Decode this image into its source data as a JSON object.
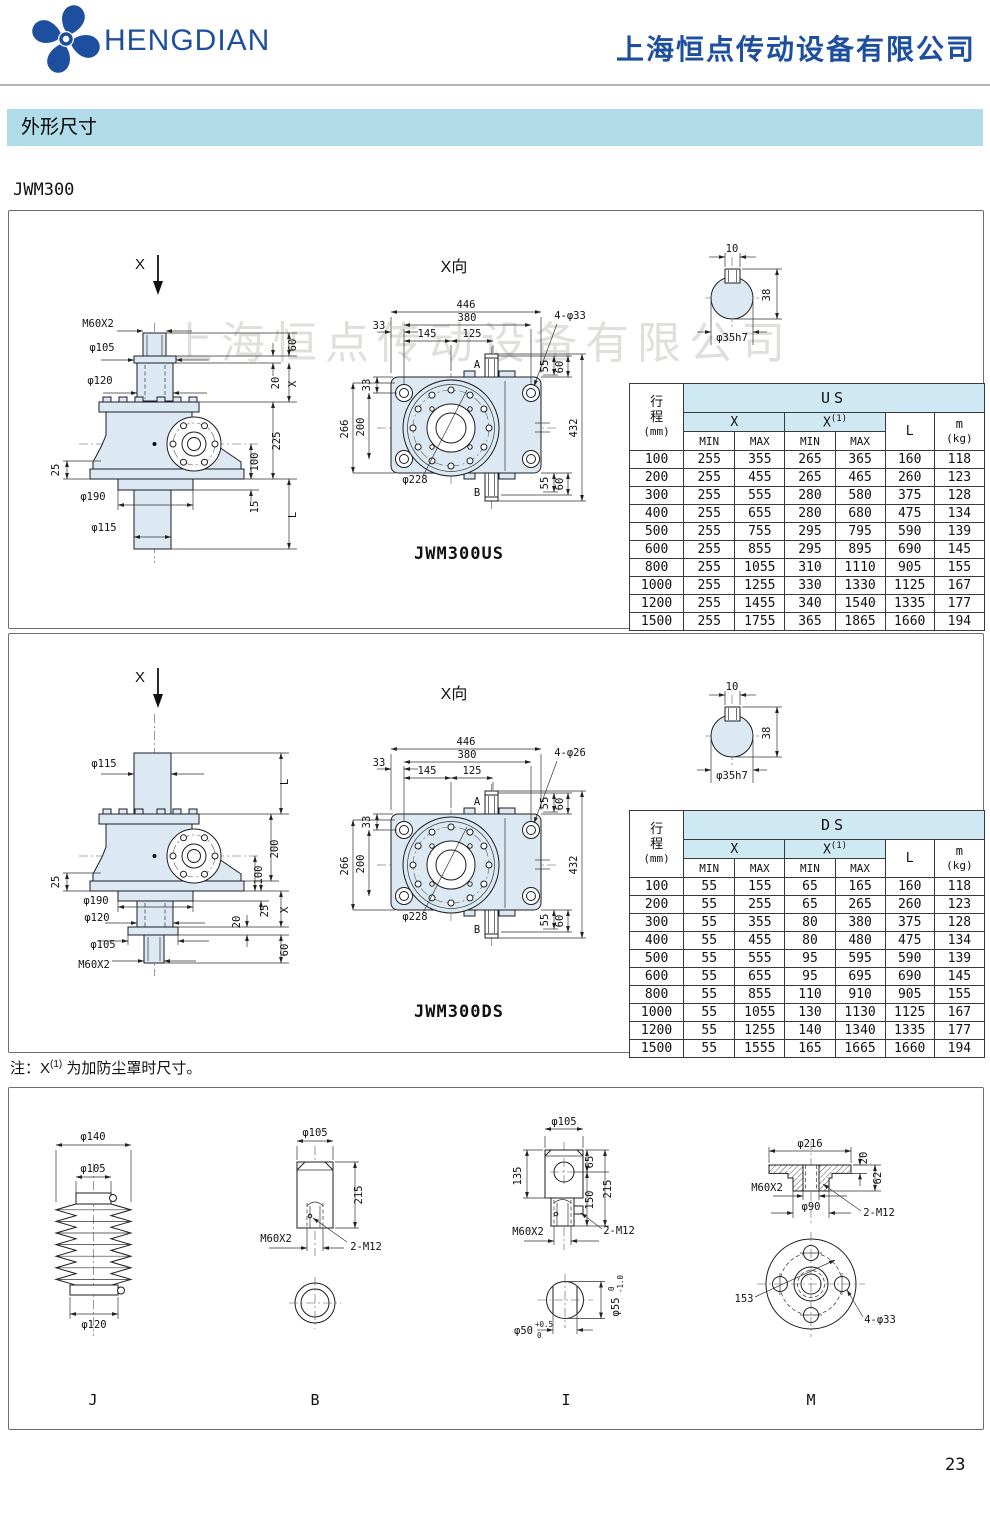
{
  "header": {
    "brand": "HENGDIAN",
    "company": "上海恒点传动设备有限公司"
  },
  "section_title": "外形尺寸",
  "model": "JWM300",
  "watermark": "上海恒点传动设备有限公司",
  "note": {
    "prefix": "注：X",
    "sup": "(1)",
    "suffix": "为加防尘罩时尺寸。"
  },
  "page_number": "23",
  "panel_us": {
    "view_label": "X向",
    "caption": "JWM300US",
    "side": {
      "x_mark": "X",
      "m60": "M60X2",
      "d105": "φ105",
      "d120": "φ120",
      "l25": "25",
      "d190": "φ190",
      "d115": "φ115",
      "r60": "60",
      "r20": "20",
      "rx": "X",
      "r225": "225",
      "r100": "100",
      "r15": "15",
      "rl": "L"
    },
    "front": {
      "w446": "446",
      "w380": "380",
      "w145": "145",
      "w125": "125",
      "t33": "33",
      "l33": "33",
      "l266": "266",
      "l200": "200",
      "bc": "φ228",
      "holes": "4-φ33",
      "a": "A",
      "b": "B",
      "t55": "55",
      "t60": "60",
      "h432": "432",
      "b55": "55",
      "b60": "60"
    },
    "shaft": {
      "k10": "10",
      "h38": "38",
      "dia": "φ35h7"
    }
  },
  "panel_ds": {
    "view_label": "X向",
    "caption": "JWM300DS",
    "side": {
      "x_mark": "X",
      "d115": "φ115",
      "l25": "25",
      "d190": "φ190",
      "d120": "φ120",
      "d105": "φ105",
      "m60": "M60X2",
      "rl": "L",
      "r200": "200",
      "r100": "100",
      "r25": "25",
      "rx": "X",
      "r20": "20",
      "r60": "60"
    },
    "front": {
      "w446": "446",
      "w380": "380",
      "w145": "145",
      "w125": "125",
      "t33": "33",
      "l33": "33",
      "l266": "266",
      "l200": "200",
      "bc": "φ228",
      "holes": "4-φ26",
      "a": "A",
      "b": "B",
      "t55": "55",
      "t60": "60",
      "h432": "432",
      "b55": "55",
      "b60": "60"
    },
    "shaft": {
      "k10": "10",
      "h38": "38",
      "dia": "φ35h7"
    }
  },
  "table_us": {
    "group": "US",
    "stroke_l1": "行",
    "stroke_l2": "程",
    "stroke_l3": "(mm)",
    "x": "X",
    "x1": "X",
    "x1_sup": "(1)",
    "min": "MIN",
    "max": "MAX",
    "l": "L",
    "m": "m",
    "m_unit": "(kg)",
    "rows": [
      [
        "100",
        "255",
        "355",
        "265",
        "365",
        "160",
        "118"
      ],
      [
        "200",
        "255",
        "455",
        "265",
        "465",
        "260",
        "123"
      ],
      [
        "300",
        "255",
        "555",
        "280",
        "580",
        "375",
        "128"
      ],
      [
        "400",
        "255",
        "655",
        "280",
        "680",
        "475",
        "134"
      ],
      [
        "500",
        "255",
        "755",
        "295",
        "795",
        "590",
        "139"
      ],
      [
        "600",
        "255",
        "855",
        "295",
        "895",
        "690",
        "145"
      ],
      [
        "800",
        "255",
        "1055",
        "310",
        "1110",
        "905",
        "155"
      ],
      [
        "1000",
        "255",
        "1255",
        "330",
        "1330",
        "1125",
        "167"
      ],
      [
        "1200",
        "255",
        "1455",
        "340",
        "1540",
        "1335",
        "177"
      ],
      [
        "1500",
        "255",
        "1755",
        "365",
        "1865",
        "1660",
        "194"
      ]
    ]
  },
  "table_ds": {
    "group": "DS",
    "stroke_l1": "行",
    "stroke_l2": "程",
    "stroke_l3": "(mm)",
    "x": "X",
    "x1": "X",
    "x1_sup": "(1)",
    "min": "MIN",
    "max": "MAX",
    "l": "L",
    "m": "m",
    "m_unit": "(kg)",
    "rows": [
      [
        "100",
        "55",
        "155",
        "65",
        "165",
        "160",
        "118"
      ],
      [
        "200",
        "55",
        "255",
        "65",
        "265",
        "260",
        "123"
      ],
      [
        "300",
        "55",
        "355",
        "80",
        "380",
        "375",
        "128"
      ],
      [
        "400",
        "55",
        "455",
        "80",
        "480",
        "475",
        "134"
      ],
      [
        "500",
        "55",
        "555",
        "95",
        "595",
        "590",
        "139"
      ],
      [
        "600",
        "55",
        "655",
        "95",
        "695",
        "690",
        "145"
      ],
      [
        "800",
        "55",
        "855",
        "110",
        "910",
        "905",
        "155"
      ],
      [
        "1000",
        "55",
        "1055",
        "130",
        "1130",
        "1125",
        "167"
      ],
      [
        "1200",
        "55",
        "1255",
        "140",
        "1340",
        "1335",
        "177"
      ],
      [
        "1500",
        "55",
        "1555",
        "165",
        "1665",
        "1660",
        "194"
      ]
    ]
  },
  "accessories": {
    "j": {
      "label": "J",
      "d140": "φ140",
      "d105": "φ105",
      "d120": "φ120"
    },
    "b": {
      "label": "B",
      "d105": "φ105",
      "h215": "215",
      "m60": "M60X2",
      "m12": "2-M12"
    },
    "i": {
      "label": "I",
      "d105": "φ105",
      "h135": "135",
      "h65": "65",
      "h150": "150",
      "h215": "215",
      "m60": "M60X2",
      "m12": "2-M12",
      "d50": "φ50",
      "d50_t1": "+0.5",
      "d50_t2": "0",
      "d55": "φ55",
      "d55_t1": "0",
      "d55_t2": "-1.0"
    },
    "m": {
      "label": "M",
      "d216": "φ216",
      "h20": "20",
      "h62": "62",
      "m60": "M60X2",
      "d90": "φ90",
      "m12": "2-M12",
      "bc153": "153",
      "holes": "4-φ33"
    }
  }
}
